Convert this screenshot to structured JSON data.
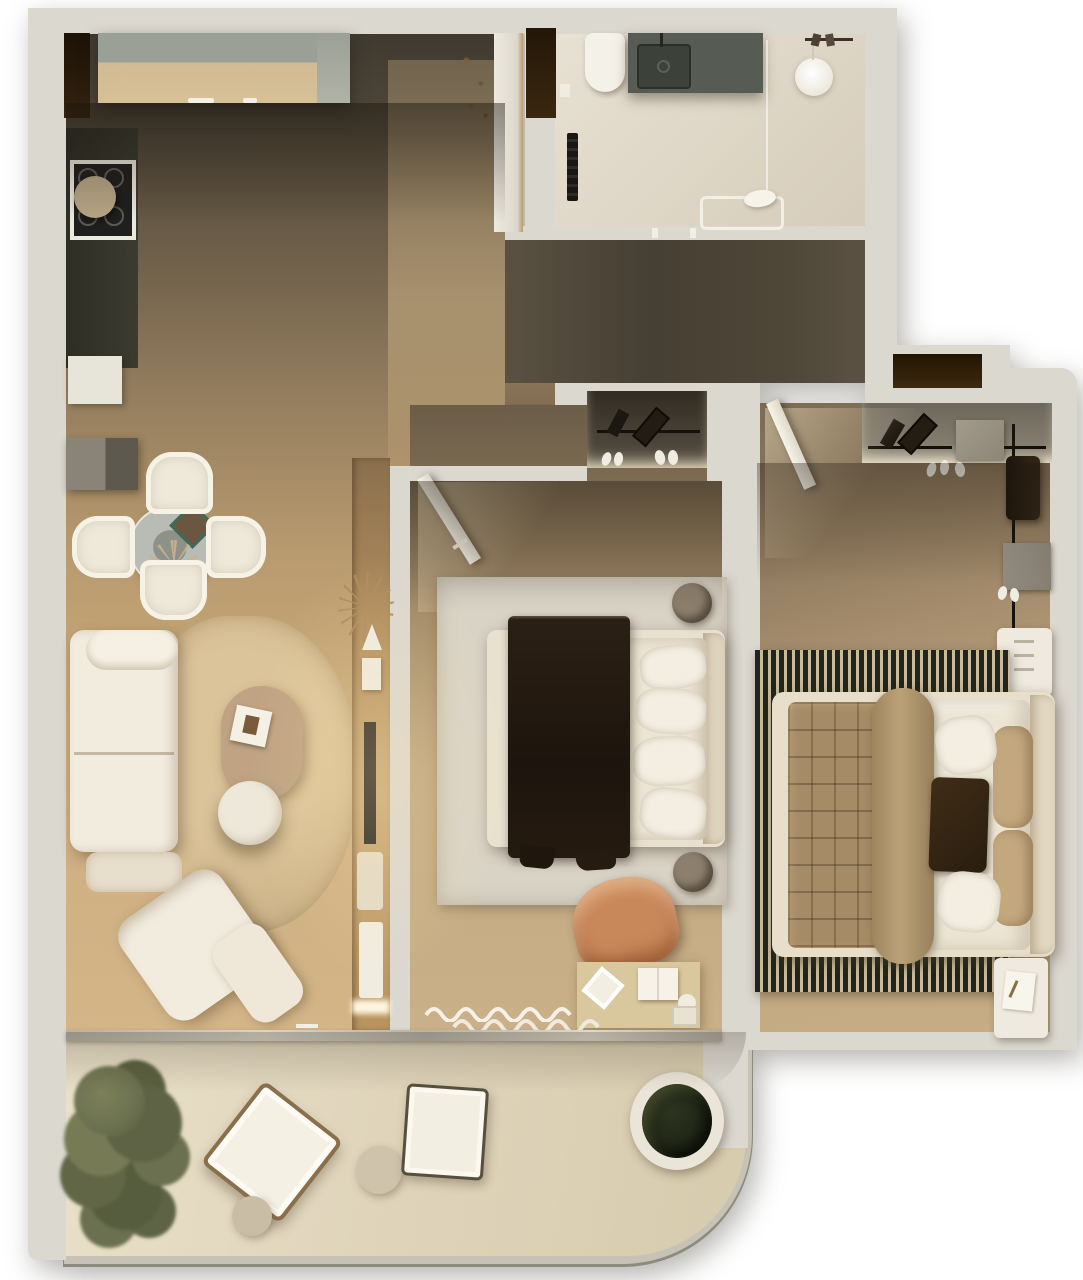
{
  "meta": {
    "title": "Two-bedroom apartment floor plan — top-down 3D render"
  },
  "palette": {
    "wall": "#dbd8d0",
    "wallShade": "#cfccc3",
    "woodDark": "#4a4234",
    "woodLight": "#c9a979",
    "hallWood": "#4e4637",
    "bathFloor": "#e3dccd",
    "balconyFloor": "#e2d8bf",
    "rugLiving": "#d5bd92",
    "rugBed1": "#d9d3c6",
    "rugBed2": "#232819",
    "sofaWhite": "#f2ecdf",
    "poufBeige": "#e8decc",
    "throwDark": "#271d12",
    "quiltTan": "#a68c66",
    "duvetWhite": "#ece5d3",
    "pillowTan": "#c3a87e",
    "chairTerracotta": "#c9885a",
    "deskWood": "#d9c79e",
    "counterWood": "#d2bb92",
    "applianceGray": "#9b9f96",
    "backsplashDark": "#35352b",
    "vanityGray": "#565b53",
    "furnWhite": "#efeadf",
    "ovalTable": "#bfa383",
    "trayBronze": "#8d7f6d",
    "wardrobeGray": "#7b7568",
    "nicheDark": "#2a1c0b",
    "treeGreen": "#6b7050",
    "potPlant": "#1f2415",
    "accentTeal": "#3e6a5c",
    "boardBeige": "#b7a585"
  },
  "rooms": {
    "kitchen_living": {
      "label": "kitchen-living-room"
    },
    "bathroom": {
      "label": "bathroom"
    },
    "hallway": {
      "label": "hallway"
    },
    "bedroom_primary": {
      "label": "bedroom-1"
    },
    "bedroom_secondary": {
      "label": "bedroom-2"
    },
    "balcony": {
      "label": "balcony"
    }
  },
  "furniture": {
    "counter": {
      "label": "kitchen-counter"
    },
    "stove": {
      "label": "cooktop"
    },
    "dining": {
      "label": "dining-table-set"
    },
    "sofa": {
      "label": "sofa"
    },
    "rug_living": {
      "label": "round-rug"
    },
    "coffee_table": {
      "label": "coffee-table"
    },
    "bed1": {
      "label": "double-bed"
    },
    "bed2": {
      "label": "double-bed"
    },
    "desk": {
      "label": "desk"
    },
    "wardrobe1": {
      "label": "wardrobe-niche"
    },
    "wardrobe2": {
      "label": "wardrobe"
    },
    "bath_vanity": {
      "label": "vanity-sink"
    },
    "toilet": {
      "label": "toilet"
    },
    "bathtub": {
      "label": "bathtub"
    },
    "balcony_set": {
      "label": "lounge-chairs"
    },
    "plant_pot": {
      "label": "planter"
    },
    "tree": {
      "label": "tree"
    }
  }
}
